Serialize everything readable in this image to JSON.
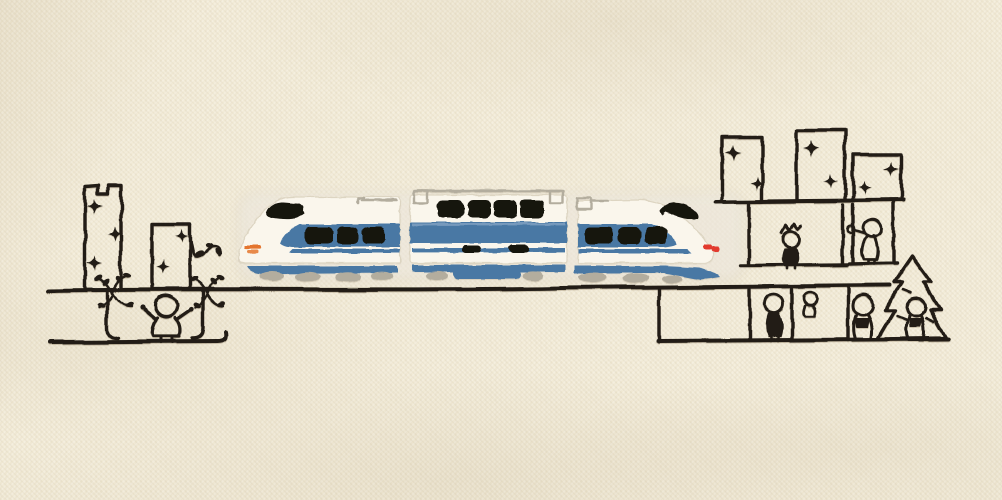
{
  "artwork": {
    "kind": "photograph of embroidery stitched on fabric",
    "surface": "cream canvas tote-bag fabric",
    "subject": "white and blue express train with black windows running through an outline-stitched city with sparkling buildings, tiny people, plants and a pine tree"
  },
  "palette": {
    "fabric": "#f2ebd7",
    "outline": "#221d15",
    "thread_white": "#faf6ec",
    "thread_blue": "#4a78a4",
    "thread_blue_light": "#82a2c3",
    "thread_black": "#17120d",
    "thread_gray": "#b3ad9e",
    "headlight_orange": "#e4752e",
    "taillight_red": "#e23a2e"
  },
  "train": {
    "cars": [
      {
        "name": "front car",
        "windows": 3,
        "details": [
          "black roof vent",
          "orange headlight",
          "blue window band",
          "thin blue stripe",
          "blue skirt",
          "gray wheels",
          "gray roof antenna"
        ]
      },
      {
        "name": "middle car",
        "windows": 4,
        "details": [
          "gray roof rail with end boxes",
          "blue belt band",
          "two black door marks",
          "blue center bogie",
          "gray wheels"
        ]
      },
      {
        "name": "rear car",
        "windows": 3,
        "details": [
          "black roof vent",
          "red tail light",
          "tapered tail",
          "blue window band",
          "blue skirt",
          "gray wheels",
          "gray roof antenna"
        ]
      }
    ]
  },
  "left_city": {
    "buildings": [
      {
        "name": "notched tower",
        "sparkles": 3
      },
      {
        "name": "small house",
        "sparkles": 2,
        "extras": [
          "curling leafy vine"
        ]
      }
    ],
    "underground_pit": {
      "figure": "cheering child with raised arms",
      "plants": 2
    }
  },
  "right_city": {
    "skyline_buildings": 3,
    "skyline_sparkles": 6,
    "platform_rooms": [
      {
        "figure": "spiky-haired child"
      },
      {
        "figure": "child holding a small balloon"
      }
    ],
    "underground": {
      "figures": [
        "standing child",
        "small hanging child",
        "walking child",
        "child beside tree"
      ],
      "tree": "pine tree"
    }
  },
  "ground": {
    "main_line": "long stitched ground line",
    "left_bottom_line": true,
    "right_cellar_boxes": 3
  }
}
